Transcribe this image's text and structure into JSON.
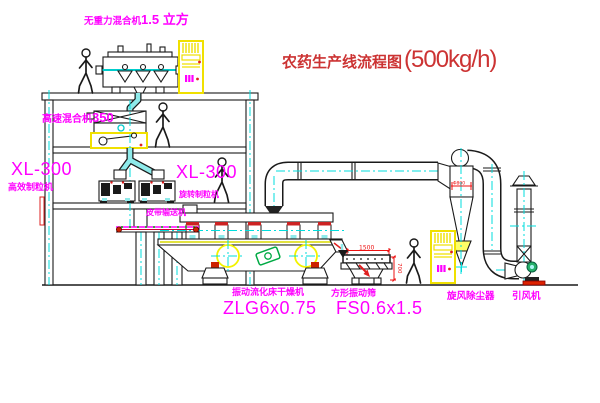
{
  "title": {
    "text": "农药生产线流程图",
    "capacity": "(500kg/h)"
  },
  "equipment": {
    "gravity_mixer": {
      "name": "无重力混合机",
      "spec": "1.5 立方"
    },
    "high_speed_mixer": {
      "name": "高速混合机",
      "spec": "350"
    },
    "granulator_left": {
      "model": "XL-300",
      "name": "高效制粒机"
    },
    "granulator_right": {
      "model": "XL-300",
      "name": "旋转制粒机"
    },
    "belt_conveyor": {
      "name": "皮带输送机"
    },
    "fluid_bed_dryer": {
      "name": "振动流化床干燥机",
      "model": "ZLG6x0.75"
    },
    "vibrating_screen": {
      "name": "方形振动筛",
      "model": "FS0.6x1.5"
    },
    "cyclone": {
      "name": "旋风除尘器"
    },
    "induced_fan": {
      "name": "引风机"
    }
  },
  "dimensions": {
    "screen_length": "1500",
    "screen_height": "700",
    "cyclone_dia": "Φ800"
  },
  "colors": {
    "label_magenta": "#ff00ff",
    "title_red": "#cc3333",
    "dimension_red": "#ee1111",
    "cabinet_yellow": "#f0e000",
    "centerline_cyan": "#00dddd",
    "pipe_cyan": "#8eeaea",
    "motor_green": "#27b06a",
    "base_red": "#dd2200"
  }
}
